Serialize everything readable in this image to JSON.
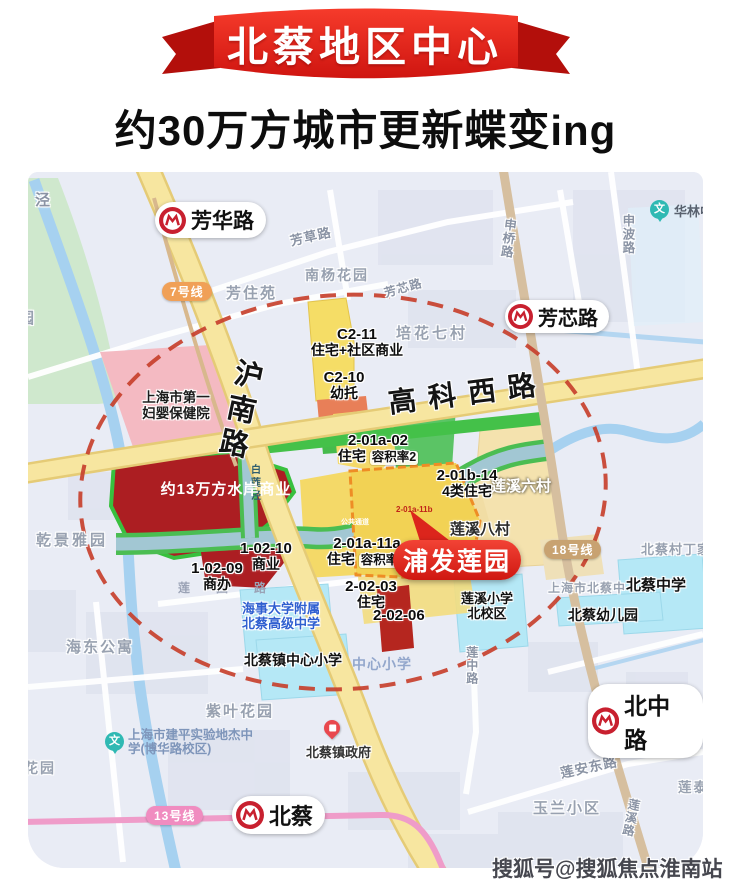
{
  "banner": {
    "title": "北蔡地区中心"
  },
  "subtitle": "约30万方城市更新蝶变ing",
  "watermark": "搜狐号@搜狐焦点淮南站",
  "icons": {
    "school_glyph": "文"
  },
  "map": {
    "stations": {
      "fanghua": "芳华路",
      "fangxin": "芳芯路",
      "beizhong": "北中路",
      "beicai": "北蔡"
    },
    "badges": {
      "line7": "7号线",
      "line18": "18号线",
      "line13": "13号线"
    },
    "roads": {
      "hunan": "沪南路",
      "gaokexi": "高科西路",
      "fangcao": "芳草路",
      "fangxin": "芳芯路",
      "shenbo": "申波路",
      "shenqiao": "申桥路",
      "lianyuan": "莲园路",
      "lianzhong": "莲中路",
      "lianan": "莲安东路",
      "lianxi": "莲溪路"
    },
    "water": {
      "bailianjing": "白莲泾",
      "jing": "泾"
    },
    "zones": {
      "c2_11_code": "C2-11",
      "c2_11_use": "住宅+社区商业",
      "c2_10_code": "C2-10",
      "c2_10_use": "幼托",
      "waterfront": "约13万方水岸商业",
      "z0102_code": "2-01a-02",
      "z0102_use": "住宅",
      "z0102_far": "容积率2",
      "z01b14_code": "2-01b-14",
      "z01b14_use": "4类住宅",
      "z01a11a_code": "2-01a-11a",
      "z01a11a_use": "住宅",
      "z01a11a_far": "容积率2",
      "z01a11b_code": "2-01a-11b",
      "z0203_code": "2-02-03",
      "z0203_use": "住宅",
      "z0206_code": "2-02-06",
      "z10210_code": "1-02-10",
      "z10210_use": "商业",
      "z10209_code": "1-02-09",
      "z10209_use": "商办",
      "greenway_note": "公共通道"
    },
    "project": "浦发莲园",
    "places": {
      "hospital": "上海市第一妇婴保健院",
      "nanyang": "南杨花园",
      "fangzhuyuan": "芳住苑",
      "peihua": "培花七村",
      "hualin": "华林中学",
      "lianxi6": "莲溪六村",
      "lianxi8": "莲溪八村",
      "beicaicun": "北蔡村丁家",
      "qianjing": "乾景雅园",
      "haidong": "海东公寓",
      "ziye": "紫叶花园",
      "haishi": "海事大学附属北蔡高级中学",
      "zhen_xiaoxue": "北蔡镇中心小学",
      "zhongxin_xiaoxue": "中心小学",
      "lianxi_xiaoxue": "莲溪小学北校区",
      "shanghai_beicai": "上海市北蔡中",
      "beicai_zhongxue": "北蔡中学",
      "beicai_youer": "北蔡幼儿园",
      "jianping": "上海市建平实验地杰中学(博华路校区)",
      "zhengfu": "北蔡镇政府",
      "yulan": "玉兰小区",
      "liantai": "莲泰苑",
      "yuan": "园",
      "huayuan": "花园"
    }
  },
  "colors": {
    "banner_red": "#e02318",
    "bubble_red": "#e02318",
    "ellipse_red": "#c7402c",
    "metro_red": "#c8202f",
    "teal_pin": "#2fb9b3",
    "line7": "#f0a057",
    "line18": "#c8a271",
    "line13": "#f08cc0"
  }
}
